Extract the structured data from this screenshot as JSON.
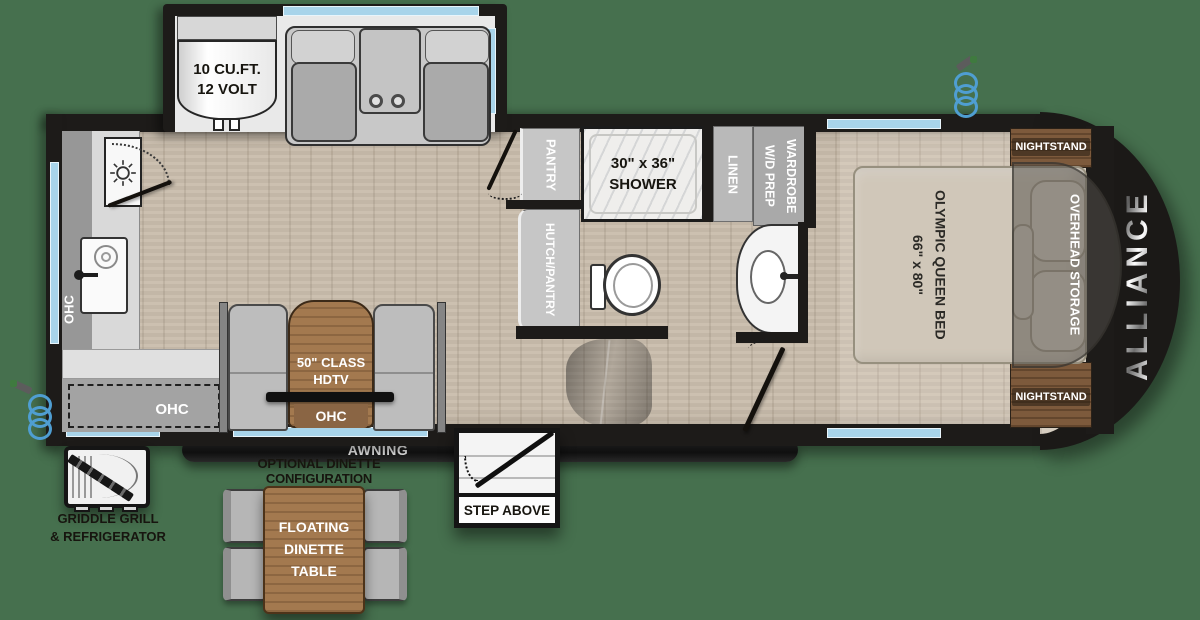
{
  "colors": {
    "background": "#46704e",
    "walls": "#1d1b19",
    "window_blue": "#a8d4ea",
    "wood_floor": "#c9bdac",
    "cabinet_brown": "#a3794f",
    "fabric_gray": "#bdbdbd",
    "hose_blue": "#4f9ed2"
  },
  "brand": {
    "name": "ALLIANCE"
  },
  "slide_out": {
    "fridge_line1": "10 CU.FT.",
    "fridge_line2": "12 VOLT"
  },
  "kitchen": {
    "ohc_side": "OHC",
    "ohc_bottom": "OHC"
  },
  "bath": {
    "pantry": "PANTRY",
    "hutch_pantry": "HUTCH/PANTRY",
    "shower_size": "30\" x 36\"",
    "shower_label": "SHOWER",
    "linen": "LINEN",
    "wardrobe": "WARDROBE\nW/D PREP"
  },
  "living": {
    "tv_line1": "50\" CLASS",
    "tv_line2": "HDTV",
    "ohc_tv": "OHC"
  },
  "bedroom": {
    "bed": "OLYMPIC QUEEN BED\n66\" x 80\"",
    "overhead_storage": "OVERHEAD STORAGE",
    "nightstand_top": "NIGHTSTAND",
    "nightstand_bottom": "NIGHTSTAND"
  },
  "exterior": {
    "awning": "AWNING",
    "step": "STEP ABOVE",
    "grill_line1": "GRIDDLE GRILL",
    "grill_line2": "& REFRIGERATOR"
  },
  "optional_dinette": {
    "title": "OPTIONAL DINETTE CONFIGURATION",
    "table": "FLOATING\nDINETTE\nTABLE"
  }
}
